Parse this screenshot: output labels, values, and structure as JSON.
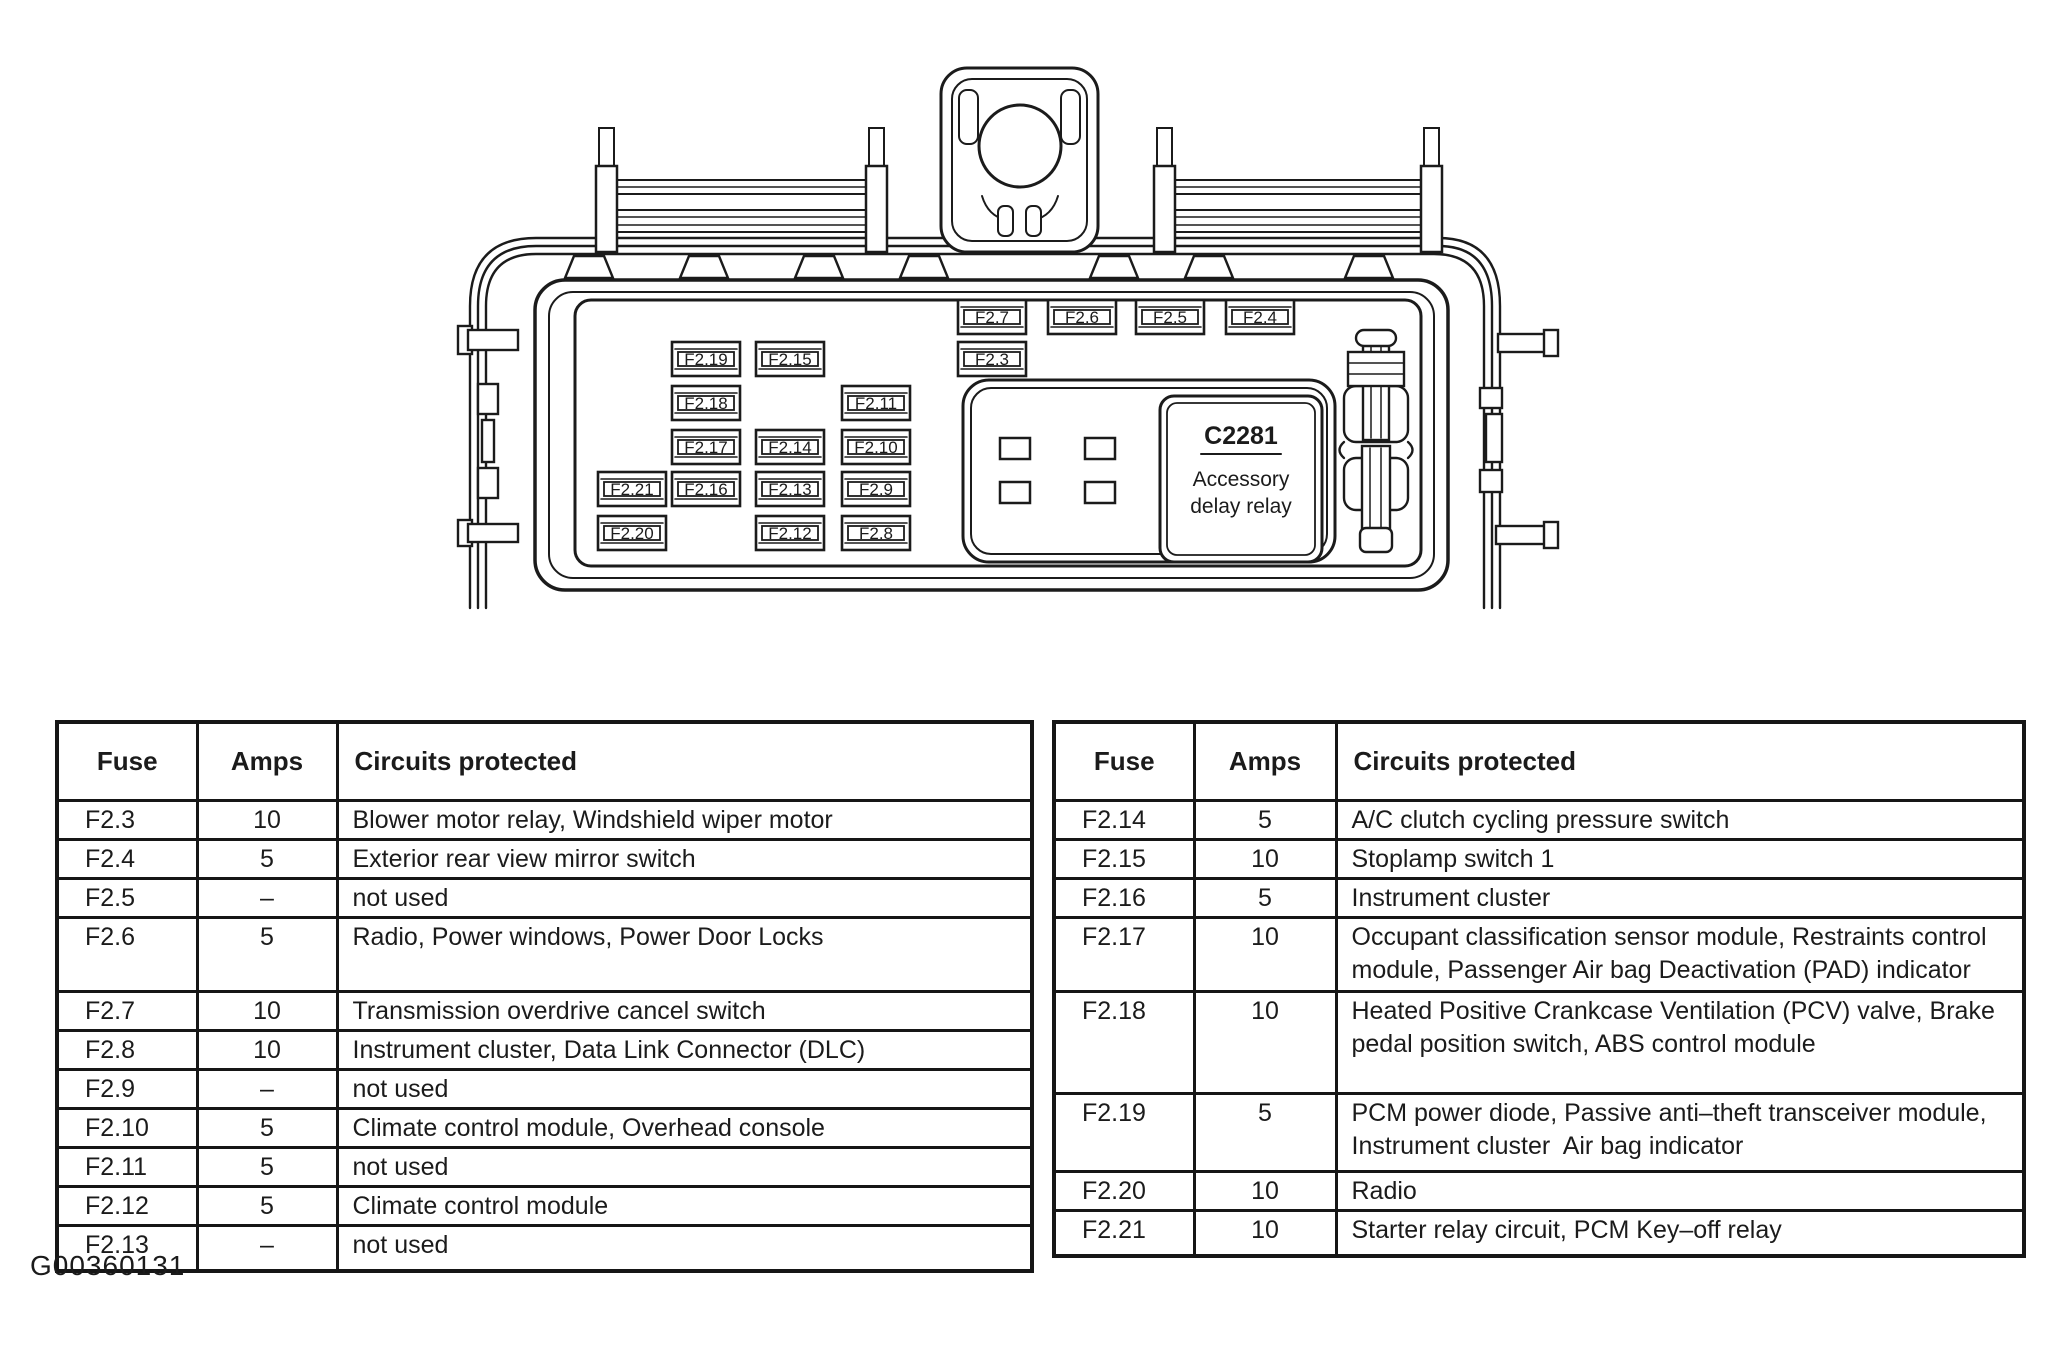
{
  "page": {
    "background": "#ffffff",
    "ink_color": "#1b1b1b",
    "figure_id": "G00360131"
  },
  "diagram": {
    "relay": {
      "id": "C2281",
      "name_lines": [
        "Accessory",
        "delay relay"
      ],
      "x": 1160,
      "y": 396,
      "w": 162,
      "h": 166
    },
    "fuse_box": {
      "w": 68,
      "h": 34
    },
    "fuses": [
      {
        "id": "F2.7",
        "x": 958,
        "y": 300
      },
      {
        "id": "F2.6",
        "x": 1048,
        "y": 300
      },
      {
        "id": "F2.5",
        "x": 1136,
        "y": 300
      },
      {
        "id": "F2.4",
        "x": 1226,
        "y": 300
      },
      {
        "id": "F2.3",
        "x": 958,
        "y": 342
      },
      {
        "id": "F2.19",
        "x": 672,
        "y": 342
      },
      {
        "id": "F2.15",
        "x": 756,
        "y": 342
      },
      {
        "id": "F2.18",
        "x": 672,
        "y": 386
      },
      {
        "id": "F2.11",
        "x": 842,
        "y": 386
      },
      {
        "id": "F2.17",
        "x": 672,
        "y": 430
      },
      {
        "id": "F2.14",
        "x": 756,
        "y": 430
      },
      {
        "id": "F2.10",
        "x": 842,
        "y": 430
      },
      {
        "id": "F2.21",
        "x": 598,
        "y": 472
      },
      {
        "id": "F2.16",
        "x": 672,
        "y": 472
      },
      {
        "id": "F2.13",
        "x": 756,
        "y": 472
      },
      {
        "id": "F2.9",
        "x": 842,
        "y": 472
      },
      {
        "id": "F2.20",
        "x": 598,
        "y": 516
      },
      {
        "id": "F2.12",
        "x": 756,
        "y": 516
      },
      {
        "id": "F2.8",
        "x": 842,
        "y": 516
      }
    ]
  },
  "tables": {
    "left": {
      "x": 55,
      "y": 720,
      "col_widths": [
        140,
        140,
        695
      ],
      "header_h": 78,
      "columns": [
        "Fuse",
        "Amps",
        "Circuits protected"
      ],
      "rows": [
        {
          "fuse": "F2.3",
          "amps": "10",
          "circuits": "Blower motor relay, Windshield wiper motor",
          "h": 36
        },
        {
          "fuse": "F2.4",
          "amps": "5",
          "circuits": "Exterior rear view mirror switch",
          "h": 36
        },
        {
          "fuse": "F2.5",
          "amps": "–",
          "circuits": "not used",
          "h": 36
        },
        {
          "fuse": "F2.6",
          "amps": "5",
          "circuits": "Radio, Power windows, Power Door Locks",
          "h": 74
        },
        {
          "fuse": "F2.7",
          "amps": "10",
          "circuits": "Transmission overdrive cancel switch",
          "h": 36
        },
        {
          "fuse": "F2.8",
          "amps": "10",
          "circuits": "Instrument cluster, Data Link Connector (DLC)",
          "h": 36
        },
        {
          "fuse": "F2.9",
          "amps": "–",
          "circuits": "not used",
          "h": 36
        },
        {
          "fuse": "F2.10",
          "amps": "5",
          "circuits": "Climate control module, Overhead console",
          "h": 36
        },
        {
          "fuse": "F2.11",
          "amps": "5",
          "circuits": "not used",
          "h": 36
        },
        {
          "fuse": "F2.12",
          "amps": "5",
          "circuits": "Climate control module",
          "h": 36
        },
        {
          "fuse": "F2.13",
          "amps": "–",
          "circuits": "not used",
          "h": 46
        }
      ]
    },
    "right": {
      "x": 1052,
      "y": 720,
      "col_widths": [
        140,
        142,
        688
      ],
      "header_h": 78,
      "columns": [
        "Fuse",
        "Amps",
        "Circuits protected"
      ],
      "rows": [
        {
          "fuse": "F2.14",
          "amps": "5",
          "circuits": "A/C clutch cycling pressure switch",
          "h": 36
        },
        {
          "fuse": "F2.15",
          "amps": "10",
          "circuits": "Stoplamp switch 1",
          "h": 36
        },
        {
          "fuse": "F2.16",
          "amps": "5",
          "circuits": "Instrument cluster",
          "h": 36
        },
        {
          "fuse": "F2.17",
          "amps": "10",
          "circuits": "Occupant classification sensor module, Restraints control module, Passenger Air bag Deactivation (PAD) indicator",
          "h": 74
        },
        {
          "fuse": "F2.18",
          "amps": "10",
          "circuits": "Heated Positive Crankcase Ventilation (PCV) valve, Brake pedal position switch, ABS control module",
          "h": 102
        },
        {
          "fuse": "F2.19",
          "amps": "5",
          "circuits": "PCM power diode, Passive anti–theft transceiver module, Instrument cluster  Air bag indicator",
          "h": 78
        },
        {
          "fuse": "F2.20",
          "amps": "10",
          "circuits": "Radio",
          "h": 36
        },
        {
          "fuse": "F2.21",
          "amps": "10",
          "circuits": "Starter relay circuit, PCM Key–off relay",
          "h": 46
        }
      ]
    }
  }
}
